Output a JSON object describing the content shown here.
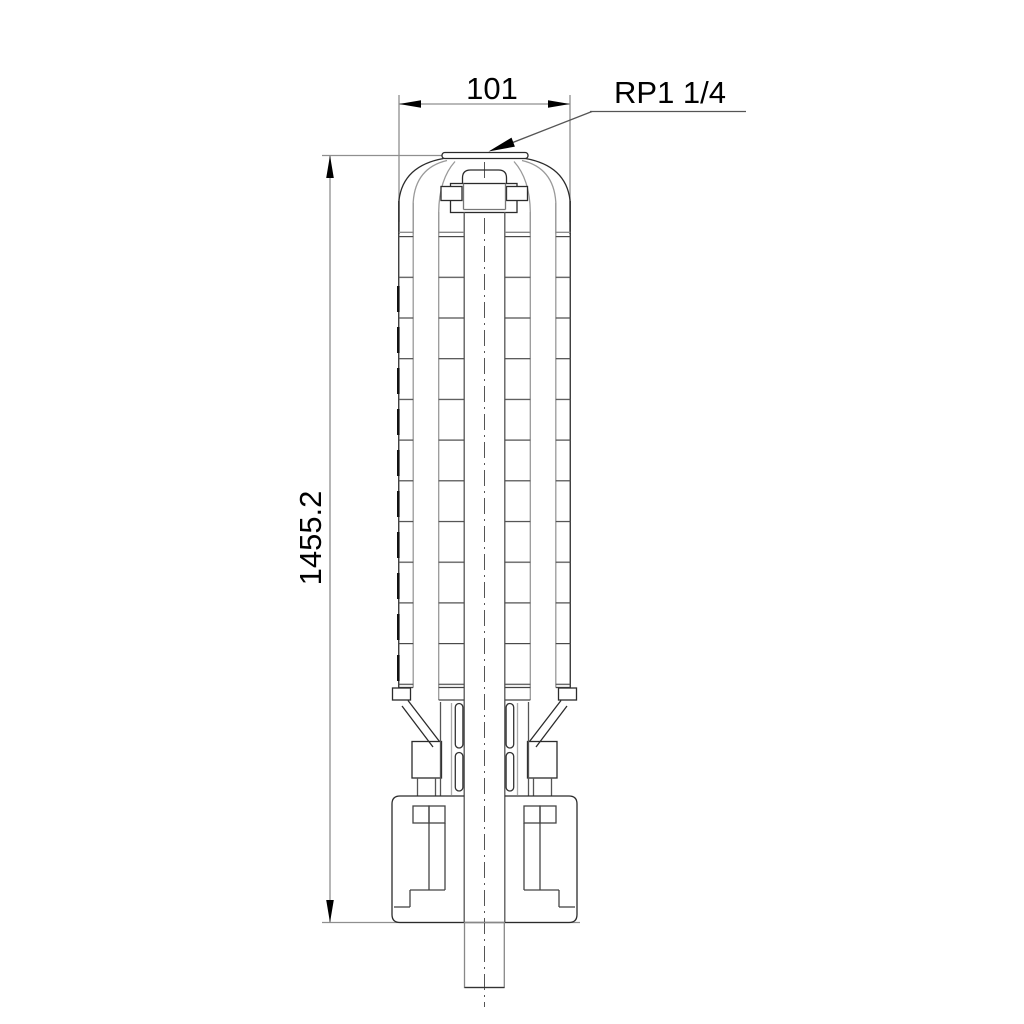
{
  "drawing": {
    "labels": {
      "width_dimension": "101",
      "thread_port": "RP1 1/4",
      "height_dimension": "1455.2"
    },
    "colors": {
      "background": "#ffffff",
      "outline": "#2b2b2b",
      "secondary_line": "#999999",
      "dimension_line": "#8f8f8f",
      "arrow": "#000000",
      "text": "#000000"
    }
  }
}
